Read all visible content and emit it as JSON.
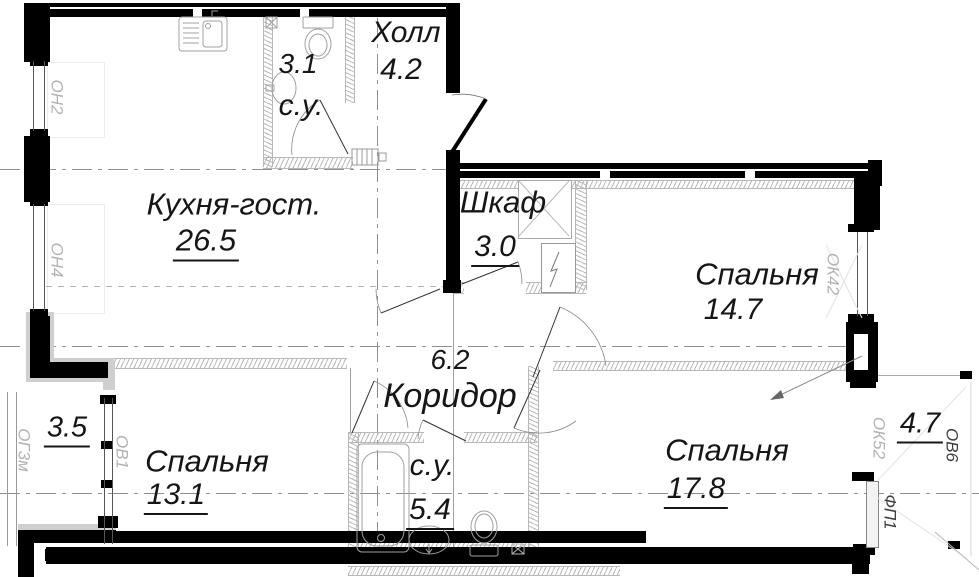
{
  "rooms": {
    "hall": {
      "name": "Холл",
      "area": "4.2"
    },
    "bathroom_top": {
      "name": "с.у.",
      "area": "3.1"
    },
    "kitchen_living": {
      "name": "Кухня-гост.",
      "area": "26.5"
    },
    "closet": {
      "name": "Шкаф",
      "area": "3.0"
    },
    "bedroom_right": {
      "name": "Спальня",
      "area": "14.7"
    },
    "corridor": {
      "name": "Коридор",
      "area": "6.2"
    },
    "bedroom_left": {
      "name": "Спальня",
      "area": "13.1"
    },
    "bathroom_bottom": {
      "name": "с.у.",
      "area": "5.4"
    },
    "bedroom_bottom_right": {
      "name": "Спальня",
      "area": "17.8"
    },
    "loggia_left": {
      "area": "3.5"
    },
    "balcony_right": {
      "area": "4.7"
    }
  },
  "window_marks": {
    "on2": "ОН2",
    "on4": "ОН4",
    "og3m": "ОГ3м",
    "ov1": "ОВ1",
    "ok42": "ОК42",
    "ok52": "ОК52",
    "ov6": "ОВ6",
    "fp1": "ФП1"
  },
  "colors": {
    "wall": "#000000",
    "hatch": "#b8b8b8",
    "axis": "#8f8f8f",
    "mark_gray": "#b3b3b3",
    "mark_dark": "#3f3f3f",
    "text": "#161616"
  }
}
